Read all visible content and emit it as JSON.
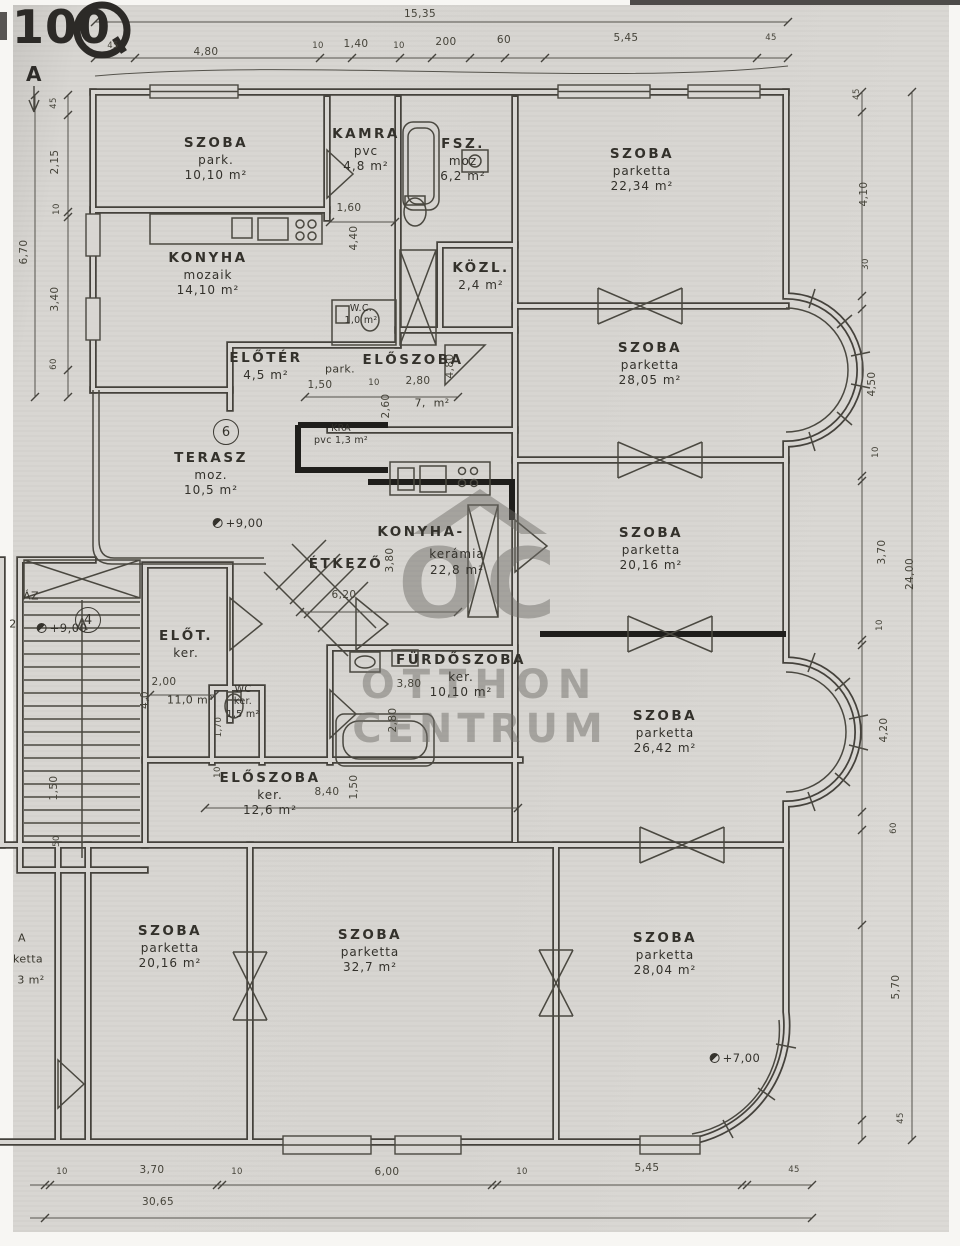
{
  "stamp": {
    "text": "100"
  },
  "watermark": {
    "monogram": "OC",
    "line1": "OTTHON",
    "line2": "CENTRUM"
  },
  "rooms": [
    {
      "x": 216,
      "y": 135,
      "l": [
        "SZOBA",
        "park.",
        "10,10 m²"
      ]
    },
    {
      "x": 366,
      "y": 126,
      "l": [
        "KAMRA",
        "pvc",
        "4,8 m²"
      ]
    },
    {
      "x": 463,
      "y": 136,
      "l": [
        "FSZ.",
        "moz",
        "6,2 m²"
      ]
    },
    {
      "x": 642,
      "y": 146,
      "l": [
        "SZOBA",
        "parketta",
        "22,34 m²"
      ]
    },
    {
      "x": 208,
      "y": 250,
      "l": [
        "KONYHA",
        "mozaik",
        "14,10 m²"
      ]
    },
    {
      "x": 481,
      "y": 260,
      "l": [
        "KÖZL.",
        "2,4 m²"
      ]
    },
    {
      "x": 361,
      "y": 303,
      "l": [
        "W.C.",
        "1,0 m²"
      ],
      "c": "sm"
    },
    {
      "x": 266,
      "y": 350,
      "l": [
        "ELŐTÉR",
        "4,5 m²"
      ]
    },
    {
      "x": 413,
      "y": 352,
      "l": [
        "ELŐSZOBA"
      ]
    },
    {
      "x": 650,
      "y": 340,
      "l": [
        "SZOBA",
        "parketta",
        "28,05 m²"
      ]
    },
    {
      "x": 341,
      "y": 423,
      "l": [
        "KRA",
        "pvc 1,3 m²"
      ],
      "c": "sm"
    },
    {
      "x": 211,
      "y": 450,
      "l": [
        "TERASZ",
        "moz.",
        "10,5 m²"
      ]
    },
    {
      "x": 421,
      "y": 524,
      "l": [
        "KONYHA-"
      ]
    },
    {
      "x": 457,
      "y": 547,
      "l": [
        "kerámia",
        "22,8 m²"
      ],
      "c": "mat"
    },
    {
      "x": 346,
      "y": 556,
      "l": [
        "ÉTKEZŐ"
      ]
    },
    {
      "x": 651,
      "y": 525,
      "l": [
        "SZOBA",
        "parketta",
        "20,16 m²"
      ]
    },
    {
      "x": 461,
      "y": 652,
      "l": [
        "FÜRDŐSZOBA",
        "ker.",
        "10,10 m²"
      ]
    },
    {
      "x": 186,
      "y": 628,
      "l": [
        "ELŐT.",
        "ker."
      ]
    },
    {
      "x": 243,
      "y": 684,
      "l": [
        "WC",
        "ker.",
        "1,5 m²"
      ],
      "c": "sm"
    },
    {
      "x": 665,
      "y": 708,
      "l": [
        "SZOBA",
        "parketta",
        "26,42 m²"
      ]
    },
    {
      "x": 270,
      "y": 770,
      "l": [
        "ELŐSZOBA",
        "ker.",
        "12,6 m²"
      ]
    },
    {
      "x": 170,
      "y": 923,
      "l": [
        "SZOBA",
        "parketta",
        "20,16 m²"
      ]
    },
    {
      "x": 370,
      "y": 927,
      "l": [
        "SZOBA",
        "parketta",
        "32,7 m²"
      ]
    },
    {
      "x": 665,
      "y": 930,
      "l": [
        "SZOBA",
        "parketta",
        "28,04 m²"
      ]
    }
  ],
  "labels": [
    {
      "t": "A",
      "x": 34,
      "y": 74,
      "c": "marker"
    },
    {
      "t": "park.",
      "x": 340,
      "y": 369,
      "c": "mat"
    },
    {
      "t": "7,  m²",
      "x": 432,
      "y": 403
    },
    {
      "t": "11,0 m²",
      "x": 190,
      "y": 700
    },
    {
      "t": "ÁZ",
      "x": 31,
      "y": 596
    },
    {
      "t": "2",
      "x": 13,
      "y": 624
    },
    {
      "t": "A",
      "x": 22,
      "y": 938
    },
    {
      "t": "ketta",
      "x": 28,
      "y": 959
    },
    {
      "t": "3 m²",
      "x": 31,
      "y": 980
    }
  ],
  "dims": [
    {
      "t": "15,35",
      "x": 420,
      "y": 14
    },
    {
      "t": "45",
      "x": 113,
      "y": 46,
      "c": "s"
    },
    {
      "t": "4,80",
      "x": 206,
      "y": 52
    },
    {
      "t": "10",
      "x": 318,
      "y": 46,
      "c": "s"
    },
    {
      "t": "1,40",
      "x": 356,
      "y": 44
    },
    {
      "t": "10",
      "x": 399,
      "y": 46,
      "c": "s"
    },
    {
      "t": "200",
      "x": 446,
      "y": 42
    },
    {
      "t": "60",
      "x": 504,
      "y": 40
    },
    {
      "t": "5,45",
      "x": 626,
      "y": 38
    },
    {
      "t": "45",
      "x": 771,
      "y": 38,
      "c": "s"
    },
    {
      "t": "6,70",
      "x": 24,
      "y": 252,
      "r": 1
    },
    {
      "t": "45",
      "x": 54,
      "y": 103,
      "r": 1,
      "c": "s"
    },
    {
      "t": "2,15",
      "x": 55,
      "y": 162,
      "r": 1
    },
    {
      "t": "10",
      "x": 57,
      "y": 209,
      "r": 1,
      "c": "s"
    },
    {
      "t": "3,40",
      "x": 55,
      "y": 299,
      "r": 1
    },
    {
      "t": "60",
      "x": 54,
      "y": 364,
      "r": 1,
      "c": "s"
    },
    {
      "t": "1,50",
      "x": 54,
      "y": 788,
      "r": 1
    },
    {
      "t": "50",
      "x": 57,
      "y": 841,
      "r": 1,
      "c": "s"
    },
    {
      "t": "45",
      "x": 857,
      "y": 94,
      "r": 1,
      "c": "s"
    },
    {
      "t": "4,10",
      "x": 864,
      "y": 194,
      "r": 1
    },
    {
      "t": "30",
      "x": 866,
      "y": 264,
      "r": 1,
      "c": "s"
    },
    {
      "t": "4,50",
      "x": 872,
      "y": 384,
      "r": 1
    },
    {
      "t": "10",
      "x": 876,
      "y": 452,
      "r": 1,
      "c": "s"
    },
    {
      "t": "3,70",
      "x": 882,
      "y": 552,
      "r": 1
    },
    {
      "t": "24,00",
      "x": 910,
      "y": 574,
      "r": 1
    },
    {
      "t": "10",
      "x": 880,
      "y": 625,
      "r": 1,
      "c": "s"
    },
    {
      "t": "4,20",
      "x": 884,
      "y": 730,
      "r": 1
    },
    {
      "t": "60",
      "x": 894,
      "y": 828,
      "r": 1,
      "c": "s"
    },
    {
      "t": "5,70",
      "x": 896,
      "y": 987,
      "r": 1
    },
    {
      "t": "45",
      "x": 901,
      "y": 1118,
      "r": 1,
      "c": "s"
    },
    {
      "t": "10",
      "x": 62,
      "y": 1172,
      "c": "s"
    },
    {
      "t": "3,70",
      "x": 152,
      "y": 1170
    },
    {
      "t": "10",
      "x": 237,
      "y": 1172,
      "c": "s"
    },
    {
      "t": "6,00",
      "x": 387,
      "y": 1172
    },
    {
      "t": "10",
      "x": 522,
      "y": 1172,
      "c": "s"
    },
    {
      "t": "5,45",
      "x": 647,
      "y": 1168
    },
    {
      "t": "45",
      "x": 794,
      "y": 1170,
      "c": "s"
    },
    {
      "t": "30,65",
      "x": 158,
      "y": 1202
    },
    {
      "t": "1,60",
      "x": 349,
      "y": 208
    },
    {
      "t": "4,40",
      "x": 354,
      "y": 238,
      "r": 1
    },
    {
      "t": "1,50",
      "x": 320,
      "y": 385
    },
    {
      "t": "10",
      "x": 374,
      "y": 383,
      "c": "s"
    },
    {
      "t": "2,80",
      "x": 418,
      "y": 381
    },
    {
      "t": "4,80",
      "x": 450,
      "y": 366,
      "r": 1
    },
    {
      "t": "2,60",
      "x": 386,
      "y": 406,
      "r": 1
    },
    {
      "t": "3,80",
      "x": 390,
      "y": 560,
      "r": 1
    },
    {
      "t": "6,20",
      "x": 344,
      "y": 595
    },
    {
      "t": "3,80",
      "x": 409,
      "y": 684
    },
    {
      "t": "2,80",
      "x": 393,
      "y": 720,
      "r": 1
    },
    {
      "t": "2,00",
      "x": 164,
      "y": 682
    },
    {
      "t": "4,0",
      "x": 145,
      "y": 700,
      "r": 1
    },
    {
      "t": "1,70",
      "x": 219,
      "y": 727,
      "r": 1,
      "c": "s"
    },
    {
      "t": "10",
      "x": 218,
      "y": 772,
      "r": 1,
      "c": "s"
    },
    {
      "t": "8,40",
      "x": 327,
      "y": 792
    },
    {
      "t": "1,50",
      "x": 354,
      "y": 787,
      "r": 1
    }
  ],
  "circles": [
    {
      "t": "6",
      "x": 226,
      "y": 432
    },
    {
      "t": "4",
      "x": 88,
      "y": 620
    }
  ],
  "levels": [
    {
      "t": "+9,00",
      "x": 238,
      "y": 523
    },
    {
      "t": "+9,00",
      "x": 62,
      "y": 628
    },
    {
      "t": "+7,00",
      "x": 735,
      "y": 1058
    }
  ]
}
